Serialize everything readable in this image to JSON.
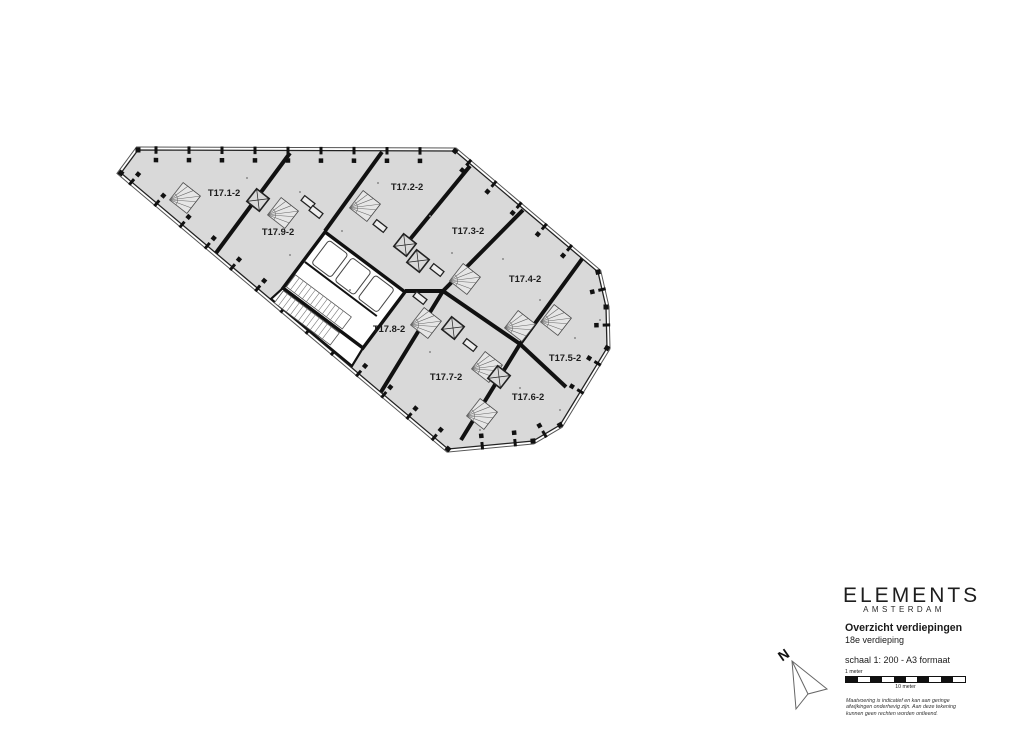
{
  "plan": {
    "units": [
      "T17.1-2",
      "T17.2-2",
      "T17.3-2",
      "T17.4-2",
      "T17.5-2",
      "T17.6-2",
      "T17.7-2",
      "T17.8-2",
      "T17.9-2"
    ],
    "colors": {
      "floor": "#d9d9d9",
      "wall": "#111111",
      "background": "#ffffff"
    }
  },
  "title_block": {
    "brand": "ELEMENTS",
    "brand_city": "AMSTERDAM",
    "title": "Overzicht verdiepingen",
    "subtitle": "18e verdieping",
    "scale_text": "schaal 1: 200 - A3 formaat",
    "scale_bar": {
      "label_top": "1 meter",
      "label_bottom": "10 meter",
      "segments": 10
    },
    "disclaimer": [
      "Maatvoering is indicatief en kan aan geringe",
      "afwijkingen onderhevig zijn. Aan deze tekening",
      "kunnen geen rechten worden ontleend."
    ]
  },
  "north_arrow": {
    "label": "N"
  }
}
